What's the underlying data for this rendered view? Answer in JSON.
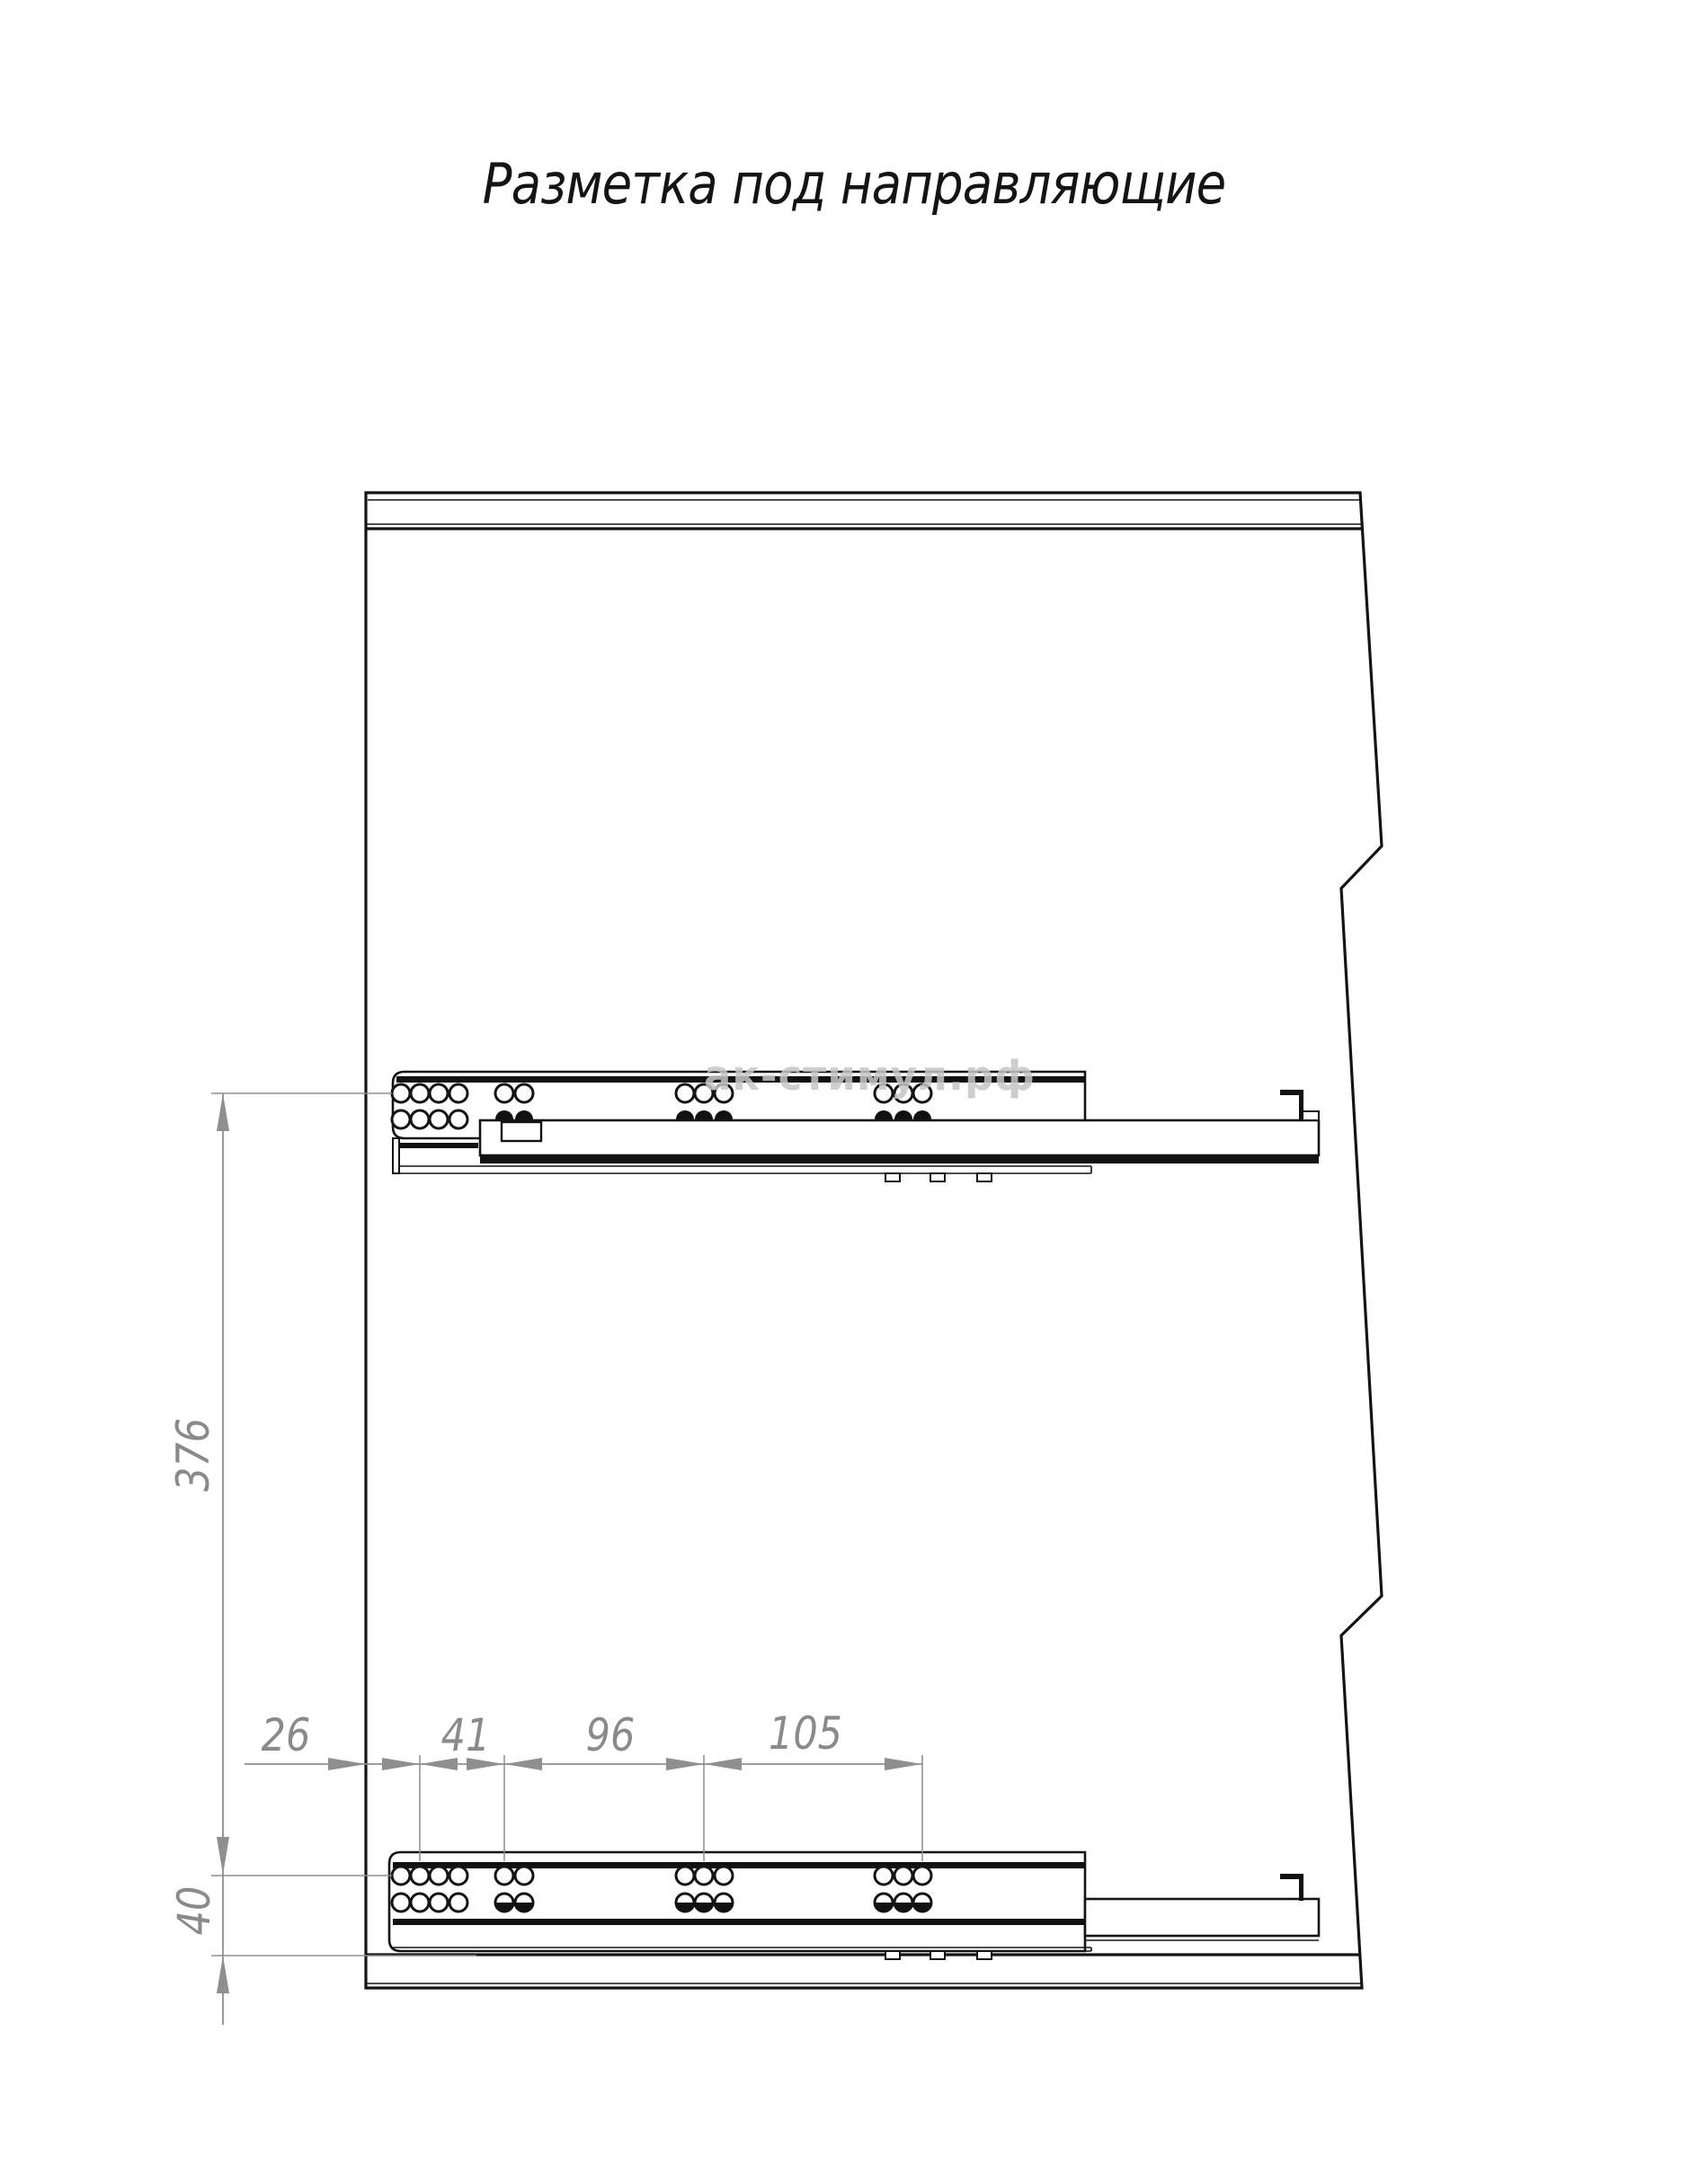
{
  "title": "Разметка под направляющие",
  "watermark": "ак-стимул.рф",
  "dimensions": {
    "horizontal_chain": [
      "26",
      "41",
      "96",
      "105"
    ],
    "slide_spacing": "376",
    "bottom_offset": "40"
  },
  "colors": {
    "drawing_line": "#141414",
    "dimension": "#8a8a8a",
    "watermark": "#c6c6c6",
    "background": "#ffffff"
  }
}
